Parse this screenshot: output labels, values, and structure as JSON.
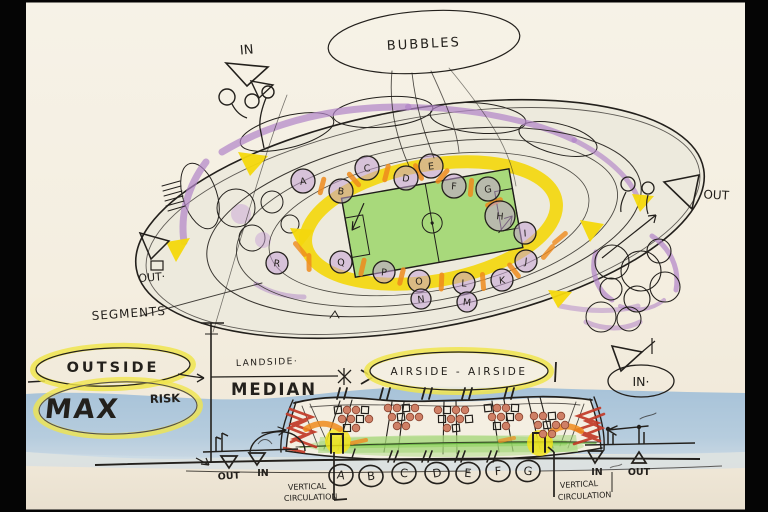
{
  "labels": {
    "bubbles": "BUBBLES",
    "in_top": "IN",
    "out_right": "OUT",
    "out_left": "OUT·",
    "segments": "SEGMENTS",
    "outside": "OUTSIDE",
    "max": "MAX",
    "risk": "RISK",
    "landside": "LANDSIDE·",
    "median": "MEDIAN",
    "airside": "AIRSIDE - AIRSIDE",
    "in_right": "IN·",
    "out_bottom_left": "OUT",
    "in_bottom_left": "IN",
    "in_bottom_right": "IN",
    "out_bottom_right": "OUT",
    "vc_left_line1": "VERTICAL",
    "vc_left_line2": "CIRCULATION",
    "vc_right_line1": "VERTICAL",
    "vc_right_line2": "CIRCULATION"
  },
  "plan": {
    "letters_top": [
      "A",
      "B",
      "C",
      "D",
      "E",
      "F",
      "G",
      "H"
    ],
    "letter_right": "I",
    "letters_bottom": [
      "R",
      "Q",
      "P",
      "O",
      "L",
      "K",
      "J"
    ],
    "letters_lower": [
      "N",
      "M"
    ]
  },
  "section": {
    "letters": [
      "A",
      "B",
      "C",
      "D",
      "E",
      "F",
      "G"
    ]
  },
  "colors": {
    "paper": "#f5f0e3",
    "ink": "#23201c",
    "purple": "#b083c7",
    "purple_fill": "#c5a0d6",
    "yellow": "#f3d70e",
    "yellow_soft": "#f0e54d",
    "green": "#9bd46e",
    "orange": "#ef8b1d",
    "red": "#c23a28",
    "salmon": "#cf8066",
    "sea": "#a7c3d9"
  }
}
